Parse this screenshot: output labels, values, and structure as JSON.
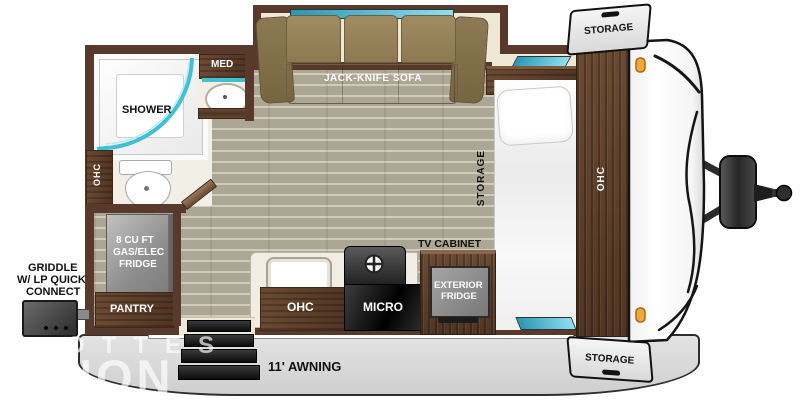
{
  "bathroom": {
    "shower": "SHOWER",
    "med": "MED",
    "ohc": "OHC"
  },
  "living_area": {
    "sofa": "JACK-KNIFE SOFA"
  },
  "kitchen": {
    "fridge": [
      "8 CU FT",
      "GAS/ELEC",
      "FRIDGE"
    ],
    "pantry": "PANTRY",
    "ohc": "OHC",
    "micro": "MICRO",
    "exterior_fridge": [
      "EXTERIOR",
      "FRIDGE"
    ],
    "tv_cabinet": "TV CABINET"
  },
  "bedroom": {
    "under_bed_storage": "STORAGE",
    "front_ohc": "OHC"
  },
  "exterior": {
    "griddle": [
      "GRIDDLE",
      "W/ LP QUICK",
      "CONNECT"
    ],
    "storage_front_top": "STORAGE",
    "storage_front_bottom": "STORAGE",
    "awning": "11' AWNING"
  },
  "watermark": [
    "OTTES",
    "NON"
  ],
  "colors": {
    "wall": "#58392b",
    "wood": "#5d4028",
    "floor": "#a9a593",
    "accent_teal": "#3fc0d4",
    "sofa": "#9d8a62",
    "awning_gray": "#d9d9d9",
    "marker_light": "#f2a63c",
    "front_cap": "#ffffff"
  }
}
